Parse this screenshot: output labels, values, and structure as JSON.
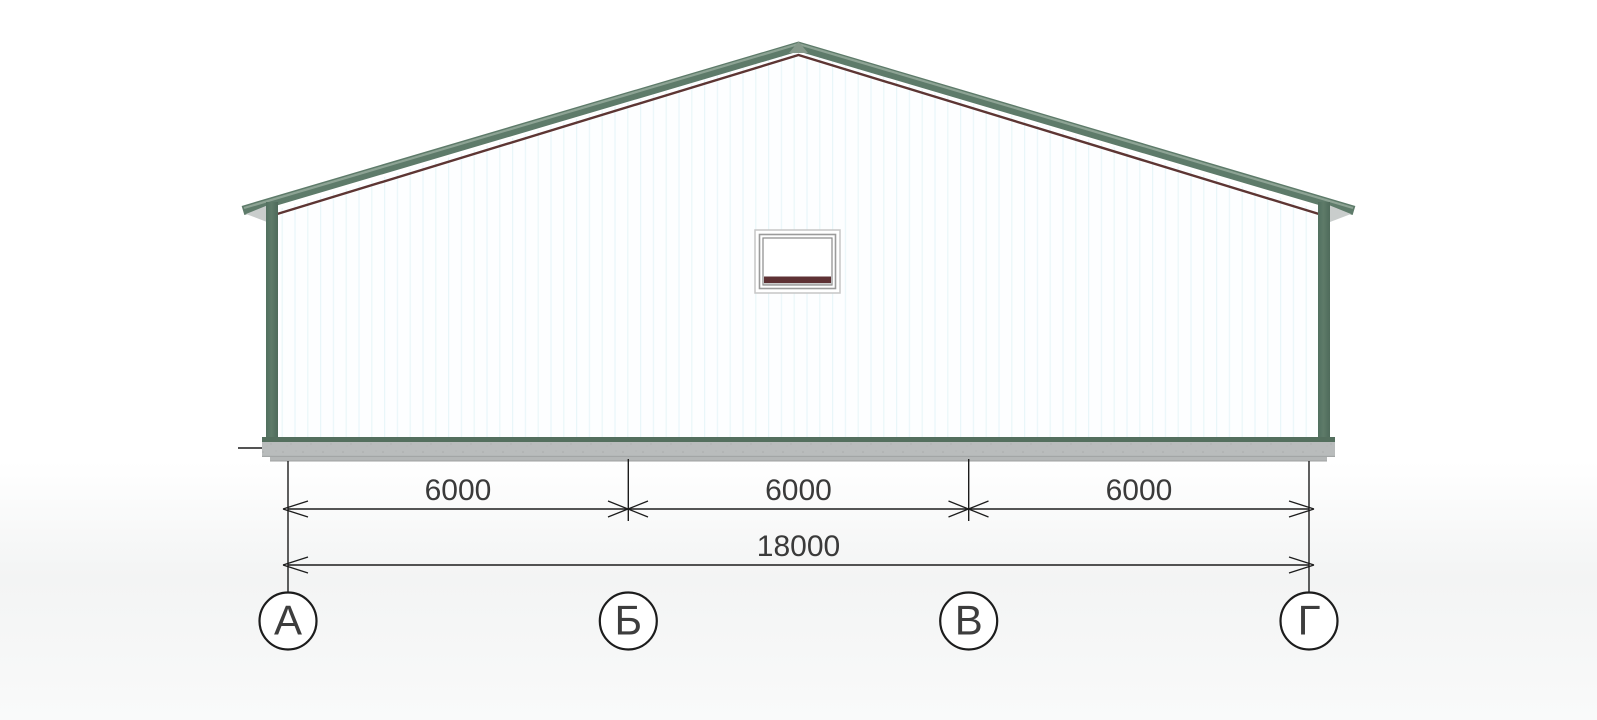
{
  "drawing": {
    "kind": "building-gable-elevation",
    "dimensions": {
      "row1": [
        {
          "label": "6000"
        },
        {
          "label": "6000"
        },
        {
          "label": "6000"
        }
      ],
      "total": {
        "label": "18000"
      }
    },
    "axes": [
      {
        "label": "А"
      },
      {
        "label": "Б"
      },
      {
        "label": "В"
      },
      {
        "label": "Г"
      }
    ],
    "colors": {
      "roof_green": "#5e7b6a",
      "roof_highlight": "#8da394",
      "fascia_maroon": "#5d3533",
      "column_green": "#587565",
      "base_trim_green": "#546f5e",
      "foundation_gray": "#b9bcbc",
      "foundation_step_gray": "#b4b7b7",
      "soffit_gray": "#c9cdcc",
      "wall_white": "#fdfeff",
      "wall_stripe": "#e9f6f9",
      "vent_slat_maroon": "#5e3134",
      "line_black": "#1c1c1c",
      "text_gray": "#3a3a3a"
    }
  }
}
